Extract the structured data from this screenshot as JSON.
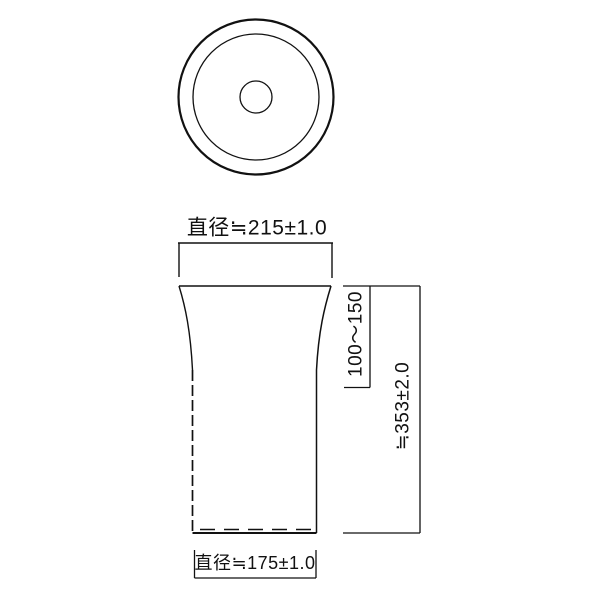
{
  "labels": {
    "top_diameter": "直径≒215±1.0",
    "upper_height_range": "100〜150",
    "total_height": "≒353±2.0",
    "bottom_diameter": "直径≒175±1.0"
  },
  "colors": {
    "line": "#111111",
    "background": "#ffffff"
  }
}
